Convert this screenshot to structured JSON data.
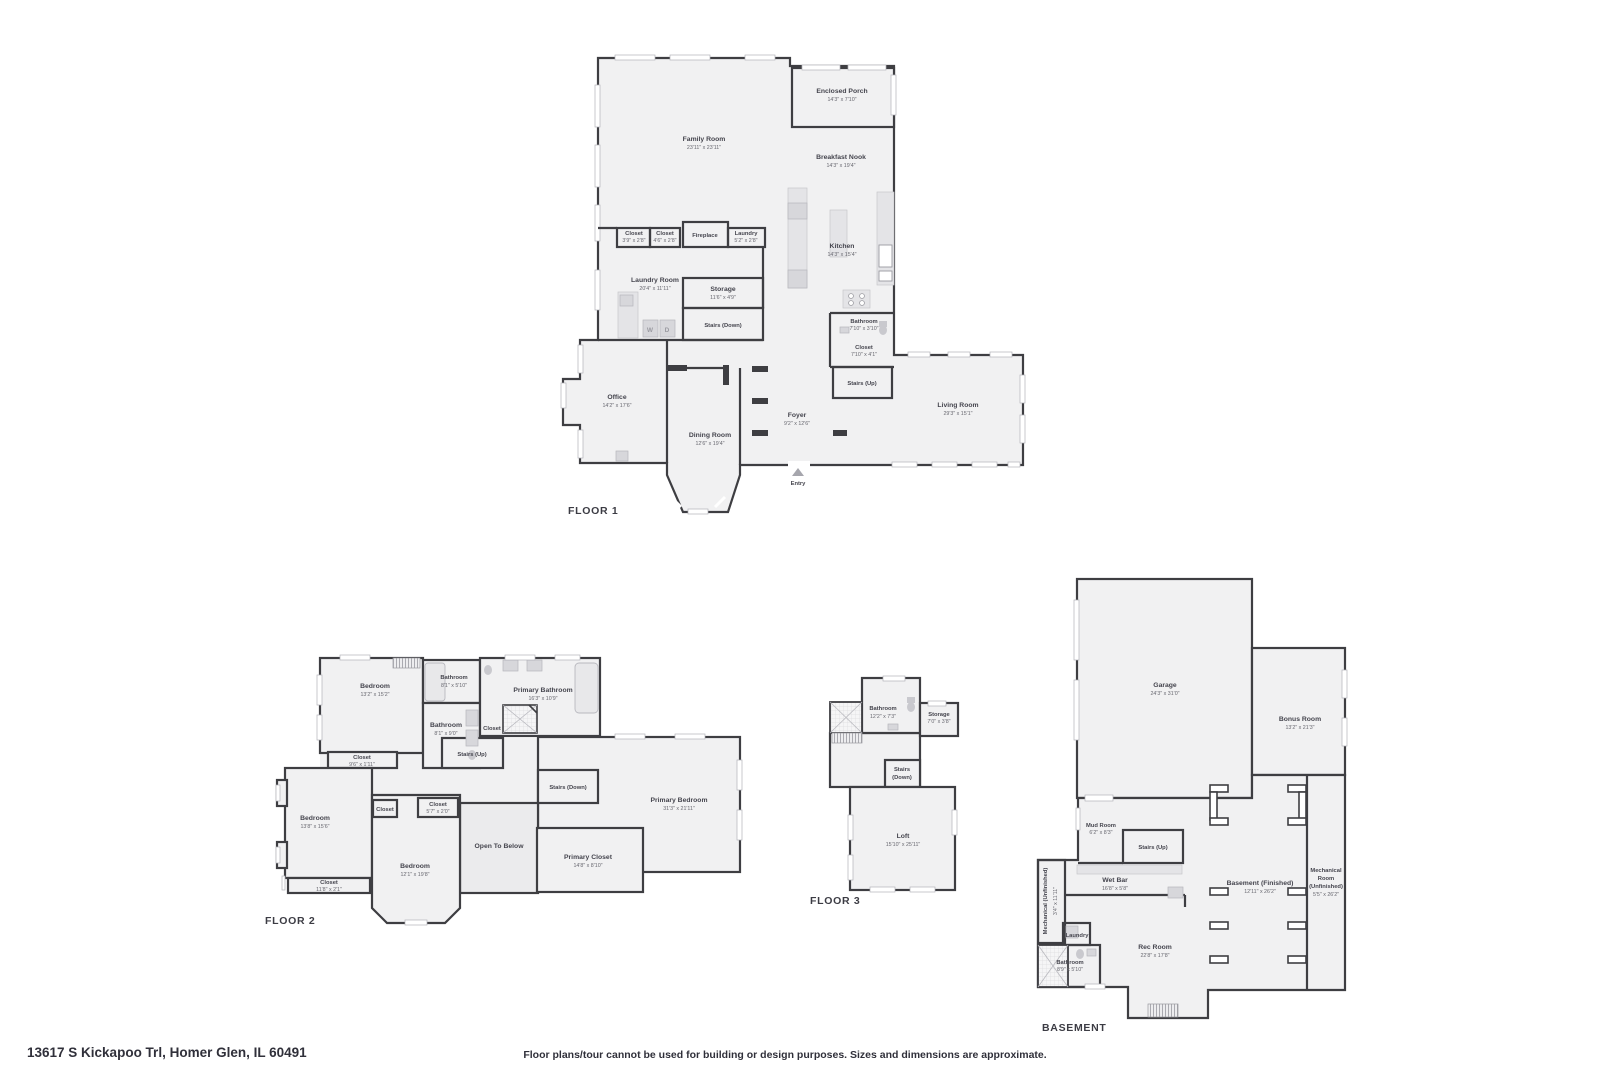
{
  "page": {
    "address": "13617 S Kickapoo Trl, Homer Glen, IL 60491",
    "disclaimer": "Floor plans/tour cannot be used for building or design purposes. Sizes and dimensions are approximate."
  },
  "floor1": {
    "title": "FLOOR 1",
    "rooms": {
      "family_room": {
        "name": "Family Room",
        "dims": "23'11\" x 23'11\""
      },
      "enclosed_porch": {
        "name": "Enclosed Porch",
        "dims": "14'3\" x 7'10\""
      },
      "breakfast_nook": {
        "name": "Breakfast Nook",
        "dims": "14'3\" x 19'4\""
      },
      "kitchen": {
        "name": "Kitchen",
        "dims": "14'3\" x 15'4\""
      },
      "closet_a": {
        "name": "Closet",
        "dims": "3'9\" x 2'8\""
      },
      "closet_b": {
        "name": "Closet",
        "dims": "4'6\" x 2'8\""
      },
      "fireplace": {
        "name": "Fireplace"
      },
      "laundry_closet": {
        "name": "Laundry",
        "dims": "5'2\" x 2'8\""
      },
      "laundry_room": {
        "name": "Laundry Room",
        "dims": "20'4\" x 11'11\""
      },
      "storage": {
        "name": "Storage",
        "dims": "11'6\" x 4'9\""
      },
      "stairs_down": {
        "name": "Stairs (Down)"
      },
      "bathroom": {
        "name": "Bathroom",
        "dims": "7'10\" x 3'10\""
      },
      "closet_c": {
        "name": "Closet",
        "dims": "7'10\" x 4'1\""
      },
      "stairs_up": {
        "name": "Stairs (Up)"
      },
      "office": {
        "name": "Office",
        "dims": "14'2\" x 17'6\""
      },
      "dining_room": {
        "name": "Dining Room",
        "dims": "12'6\" x 19'4\""
      },
      "foyer": {
        "name": "Foyer",
        "dims": "9'2\" x 12'6\""
      },
      "living_room": {
        "name": "Living Room",
        "dims": "29'3\" x 15'1\""
      },
      "entry": {
        "name": "Entry"
      }
    },
    "fixtures": {
      "washer": "W",
      "dryer": "D"
    }
  },
  "floor2": {
    "title": "FLOOR 2",
    "rooms": {
      "bedroom_1": {
        "name": "Bedroom",
        "dims": "13'2\" x 15'2\""
      },
      "bathroom_1": {
        "name": "Bathroom",
        "dims": "8'1\" x 5'10\""
      },
      "bathroom_2": {
        "name": "Bathroom",
        "dims": "8'1\" x 9'0\""
      },
      "primary_bathroom": {
        "name": "Primary Bathroom",
        "dims": "16'3\" x 10'9\""
      },
      "closet_pb": {
        "name": "Closet"
      },
      "closet_1": {
        "name": "Closet",
        "dims": "9'6\" x 1'11\""
      },
      "stairs_up": {
        "name": "Stairs (Up)"
      },
      "stairs_down": {
        "name": "Stairs (Down)"
      },
      "primary_bedroom": {
        "name": "Primary Bedroom",
        "dims": "31'3\" x 21'11\""
      },
      "open_to_below": {
        "name": "Open To Below"
      },
      "primary_closet": {
        "name": "Primary Closet",
        "dims": "14'8\" x 8'10\""
      },
      "closet_small": {
        "name": "Closet"
      },
      "closet_2": {
        "name": "Closet",
        "dims": "5'7\" x 2'0\""
      },
      "bedroom_2": {
        "name": "Bedroom",
        "dims": "13'8\" x 15'6\""
      },
      "bedroom_3": {
        "name": "Bedroom",
        "dims": "12'1\" x 19'8\""
      },
      "closet_3": {
        "name": "Closet",
        "dims": "11'8\" x 2'1\""
      }
    }
  },
  "floor3": {
    "title": "FLOOR 3",
    "rooms": {
      "bathroom": {
        "name": "Bathroom",
        "dims": "12'2\" x 7'3\""
      },
      "storage": {
        "name": "Storage",
        "dims": "7'0\" x 3'8\""
      },
      "stairs_down": {
        "name": "Stairs",
        "name2": "(Down)"
      },
      "loft": {
        "name": "Loft",
        "dims": "15'10\" x 25'11\""
      }
    }
  },
  "basement": {
    "title": "BASEMENT",
    "rooms": {
      "garage": {
        "name": "Garage",
        "dims": "24'3\" x 31'0\""
      },
      "bonus_room": {
        "name": "Bonus Room",
        "dims": "13'2\" x 21'3\""
      },
      "mud_room": {
        "name": "Mud Room",
        "dims": "6'2\" x 8'3\""
      },
      "stairs_up": {
        "name": "Stairs (Up)"
      },
      "wet_bar": {
        "name": "Wet Bar",
        "dims": "16'8\" x 5'8\""
      },
      "mechanical_unfinished": {
        "name": "Mechanical (Unfinished)",
        "dims": "3'4\" x 11'11\""
      },
      "laundry": {
        "name": "Laundry"
      },
      "bathroom": {
        "name": "Bathroom",
        "dims": "8'9\" x 5'10\""
      },
      "rec_room": {
        "name": "Rec Room",
        "dims": "22'8\" x 17'8\""
      },
      "basement_finished": {
        "name": "Basement (Finished)",
        "dims": "12'11\" x 26'2\""
      },
      "mechanical_room": {
        "line1": "Mechanical",
        "line2": "Room",
        "line3": "(Unfinished)",
        "dims": "5'5\" x 26'2\""
      }
    }
  }
}
